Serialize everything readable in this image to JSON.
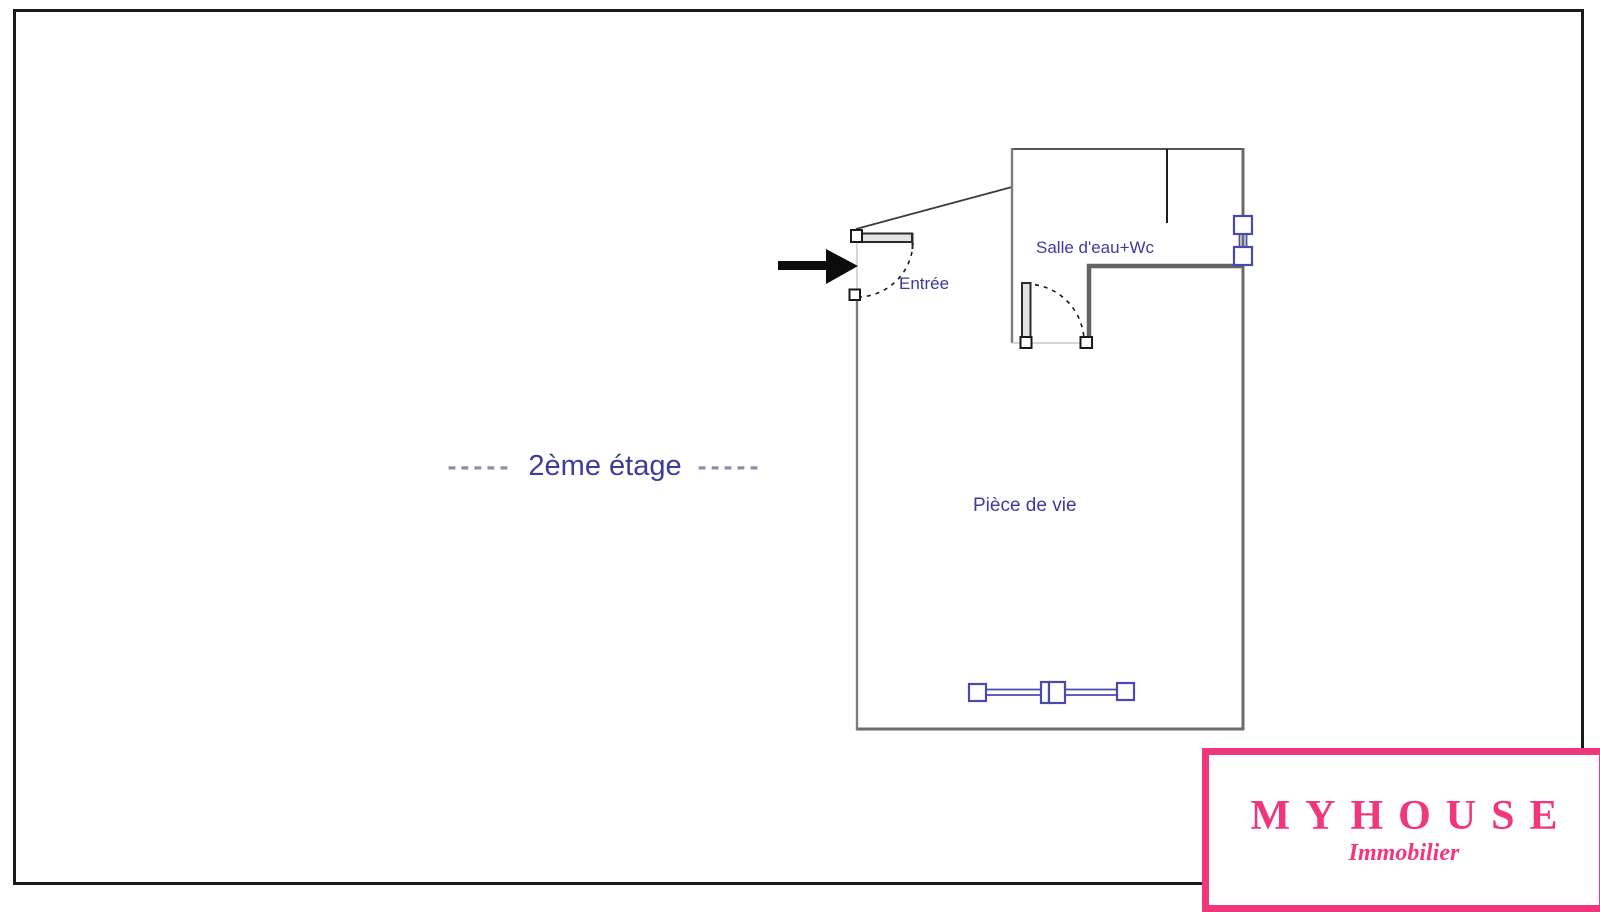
{
  "document": {
    "type": "real-estate floor plan",
    "floor_label": {
      "dashes_left": "-----",
      "text": "2ème étage",
      "dashes_right": "-----"
    }
  },
  "rooms": {
    "salle_deau": {
      "label": "Salle d'eau+Wc"
    },
    "entree": {
      "label": "Entrée"
    },
    "piece_de_vie": {
      "label": "Pièce de vie"
    }
  },
  "icons": {
    "entry_arrow": "right-pointing solid black arrow marking the entrance",
    "door_swings": "dashed quarter-circle door swing arcs",
    "windows": "blue double-line window/glazing symbols"
  },
  "branding": {
    "name": "MYHOUSE",
    "tagline": "Immobilier"
  },
  "colors": {
    "accent_pink": "#f0377e",
    "label_blue": "#3b3ba0",
    "dash_gray": "#8d8da6",
    "fixture_blue": "#4a4aae",
    "wall_gray": "#6b6b6b",
    "wall_dark": "#3c3c3c"
  }
}
